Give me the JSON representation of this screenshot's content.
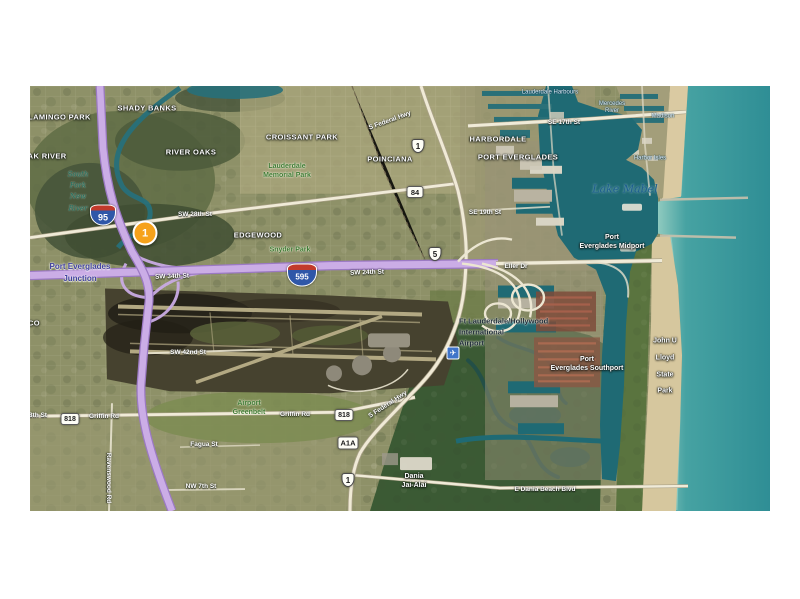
{
  "colors": {
    "marker_orange": "#F6A21B",
    "highway_lavender": "#CBADE6",
    "ocean_teal": "#2F8E95",
    "port_water": "#1F6A74",
    "beach_sand": "#D9C9A2",
    "park_green": "#3E7A33"
  },
  "map": {
    "marker": {
      "label": "1",
      "x": 115,
      "y": 147,
      "color": "#F6A21B"
    },
    "icons": [
      {
        "name": "airport-plane-icon",
        "glyph": "✈",
        "x": 423,
        "y": 267
      }
    ],
    "labels": [
      {
        "text": "Shady Banks",
        "type": "place",
        "x": 117,
        "y": 22
      },
      {
        "text": "Flamingo Park",
        "type": "place",
        "x": 27,
        "y": 31
      },
      {
        "text": "Oak River",
        "type": "place",
        "x": 14,
        "y": 70
      },
      {
        "text": "River Oaks",
        "type": "place",
        "x": 161,
        "y": 66
      },
      {
        "text": "Croissant Park",
        "type": "place",
        "x": 272,
        "y": 51
      },
      {
        "text": "Poinciana",
        "type": "place",
        "x": 360,
        "y": 73
      },
      {
        "text": "Harbordale",
        "type": "place",
        "x": 468,
        "y": 53
      },
      {
        "text": "Port Everglades",
        "type": "place",
        "x": 488,
        "y": 71
      },
      {
        "text": "Edgewood",
        "type": "place",
        "x": 228,
        "y": 149
      },
      {
        "text": "CO",
        "type": "place",
        "x": 4,
        "y": 237
      },
      {
        "lines": [
          "Port",
          "Everglades Midport"
        ],
        "type": "place-mixed",
        "x": 582,
        "y": 156
      },
      {
        "lines": [
          "Port",
          "Everglades Southport"
        ],
        "type": "place-mixed",
        "x": 557,
        "y": 278
      },
      {
        "lines": [
          "John U",
          "Lloyd",
          "State",
          "Park"
        ],
        "type": "place-tall",
        "x": 635,
        "y": 281
      },
      {
        "lines": [
          "Dania",
          "Jai-Alai"
        ],
        "type": "place-mixed",
        "x": 384,
        "y": 395
      },
      {
        "lines": [
          "Port Everglades",
          "Junction"
        ],
        "type": "place-purple",
        "x": 50,
        "y": 187
      },
      {
        "lines": [
          "Lauderdale",
          "Memorial Park"
        ],
        "type": "park",
        "x": 257,
        "y": 85
      },
      {
        "text": "Snyder Park",
        "type": "park",
        "x": 260,
        "y": 164
      },
      {
        "lines": [
          "Airport",
          "Greenbelt"
        ],
        "type": "park",
        "x": 219,
        "y": 322
      },
      {
        "text": "Lake Mabel",
        "type": "water",
        "x": 595,
        "y": 103
      },
      {
        "lines": [
          "South",
          "Fork",
          "New",
          "River"
        ],
        "type": "water-sm",
        "x": 48,
        "y": 106
      },
      {
        "lines": [
          "Ft Lauderdale/Hollywood",
          "International",
          "Airport"
        ],
        "type": "poi-dark",
        "x": 429,
        "y": 247,
        "align": "left"
      },
      {
        "text": "Lauderdale Harbours",
        "type": "tiny-blue",
        "x": 520,
        "y": 7
      },
      {
        "lines": [
          "Mercedes",
          "River"
        ],
        "type": "tiny-blue",
        "x": 582,
        "y": 22
      },
      {
        "text": "Madison",
        "type": "tiny-blue",
        "x": 633,
        "y": 31
      },
      {
        "text": "Harbor Isles",
        "type": "tiny-blue",
        "x": 620,
        "y": 73
      },
      {
        "text": "SW 28th St",
        "type": "road",
        "x": 165,
        "y": 129
      },
      {
        "text": "SW 34th St",
        "type": "road",
        "x": 142,
        "y": 191,
        "rot": -2
      },
      {
        "text": "SW 24th St",
        "type": "road",
        "x": 337,
        "y": 187,
        "rot": -2
      },
      {
        "text": "Eller Dr",
        "type": "road",
        "x": 486,
        "y": 181
      },
      {
        "text": "SE 17th St",
        "type": "road",
        "x": 534,
        "y": 37
      },
      {
        "text": "SE 19th St",
        "type": "road",
        "x": 455,
        "y": 127
      },
      {
        "text": "S Federal Hwy",
        "type": "road",
        "x": 360,
        "y": 35,
        "rot": -20
      },
      {
        "text": "S Federal Hwy",
        "type": "road",
        "x": 358,
        "y": 319,
        "rot": -33
      },
      {
        "text": "SW 48th St",
        "type": "road",
        "x": 0,
        "y": 330
      },
      {
        "text": "Griffin Rd",
        "type": "road",
        "x": 74,
        "y": 331
      },
      {
        "text": "Griffin Rd",
        "type": "road",
        "x": 265,
        "y": 329
      },
      {
        "text": "E Dania Beach Blvd",
        "type": "road",
        "x": 515,
        "y": 404
      },
      {
        "text": "SW 42nd St",
        "type": "road",
        "x": 158,
        "y": 267
      },
      {
        "text": "Ravenswood Rd",
        "type": "road",
        "x": 78,
        "y": 392,
        "rot": 90
      },
      {
        "text": "Fagua St",
        "type": "road",
        "x": 174,
        "y": 359
      },
      {
        "text": "NW 7th St",
        "type": "road",
        "x": 171,
        "y": 401
      }
    ],
    "shields": [
      {
        "kind": "interstate",
        "text": "95",
        "x": 73,
        "y": 129,
        "w": 26,
        "h": 21,
        "fs": 9
      },
      {
        "kind": "interstate",
        "text": "595",
        "x": 272,
        "y": 189,
        "w": 30,
        "h": 23,
        "fs": 8
      },
      {
        "kind": "us",
        "text": "1",
        "x": 388,
        "y": 60,
        "w": 13,
        "h": 14,
        "fs": 8
      },
      {
        "kind": "us",
        "text": "5",
        "x": 405,
        "y": 168,
        "w": 13,
        "h": 14,
        "fs": 8
      },
      {
        "kind": "us",
        "text": "1",
        "x": 318,
        "y": 394,
        "w": 13,
        "h": 14,
        "fs": 8
      },
      {
        "kind": "rect",
        "text": "84",
        "x": 385,
        "y": 106,
        "w": 17,
        "h": 12,
        "fs": 7.5
      },
      {
        "kind": "rect",
        "text": "818",
        "x": 40,
        "y": 333,
        "w": 19,
        "h": 12,
        "fs": 7
      },
      {
        "kind": "rect",
        "text": "818",
        "x": 314,
        "y": 329,
        "w": 19,
        "h": 12,
        "fs": 7
      },
      {
        "kind": "rect",
        "text": "A1A",
        "x": 318,
        "y": 357,
        "w": 21,
        "h": 13,
        "fs": 7.5
      }
    ]
  }
}
